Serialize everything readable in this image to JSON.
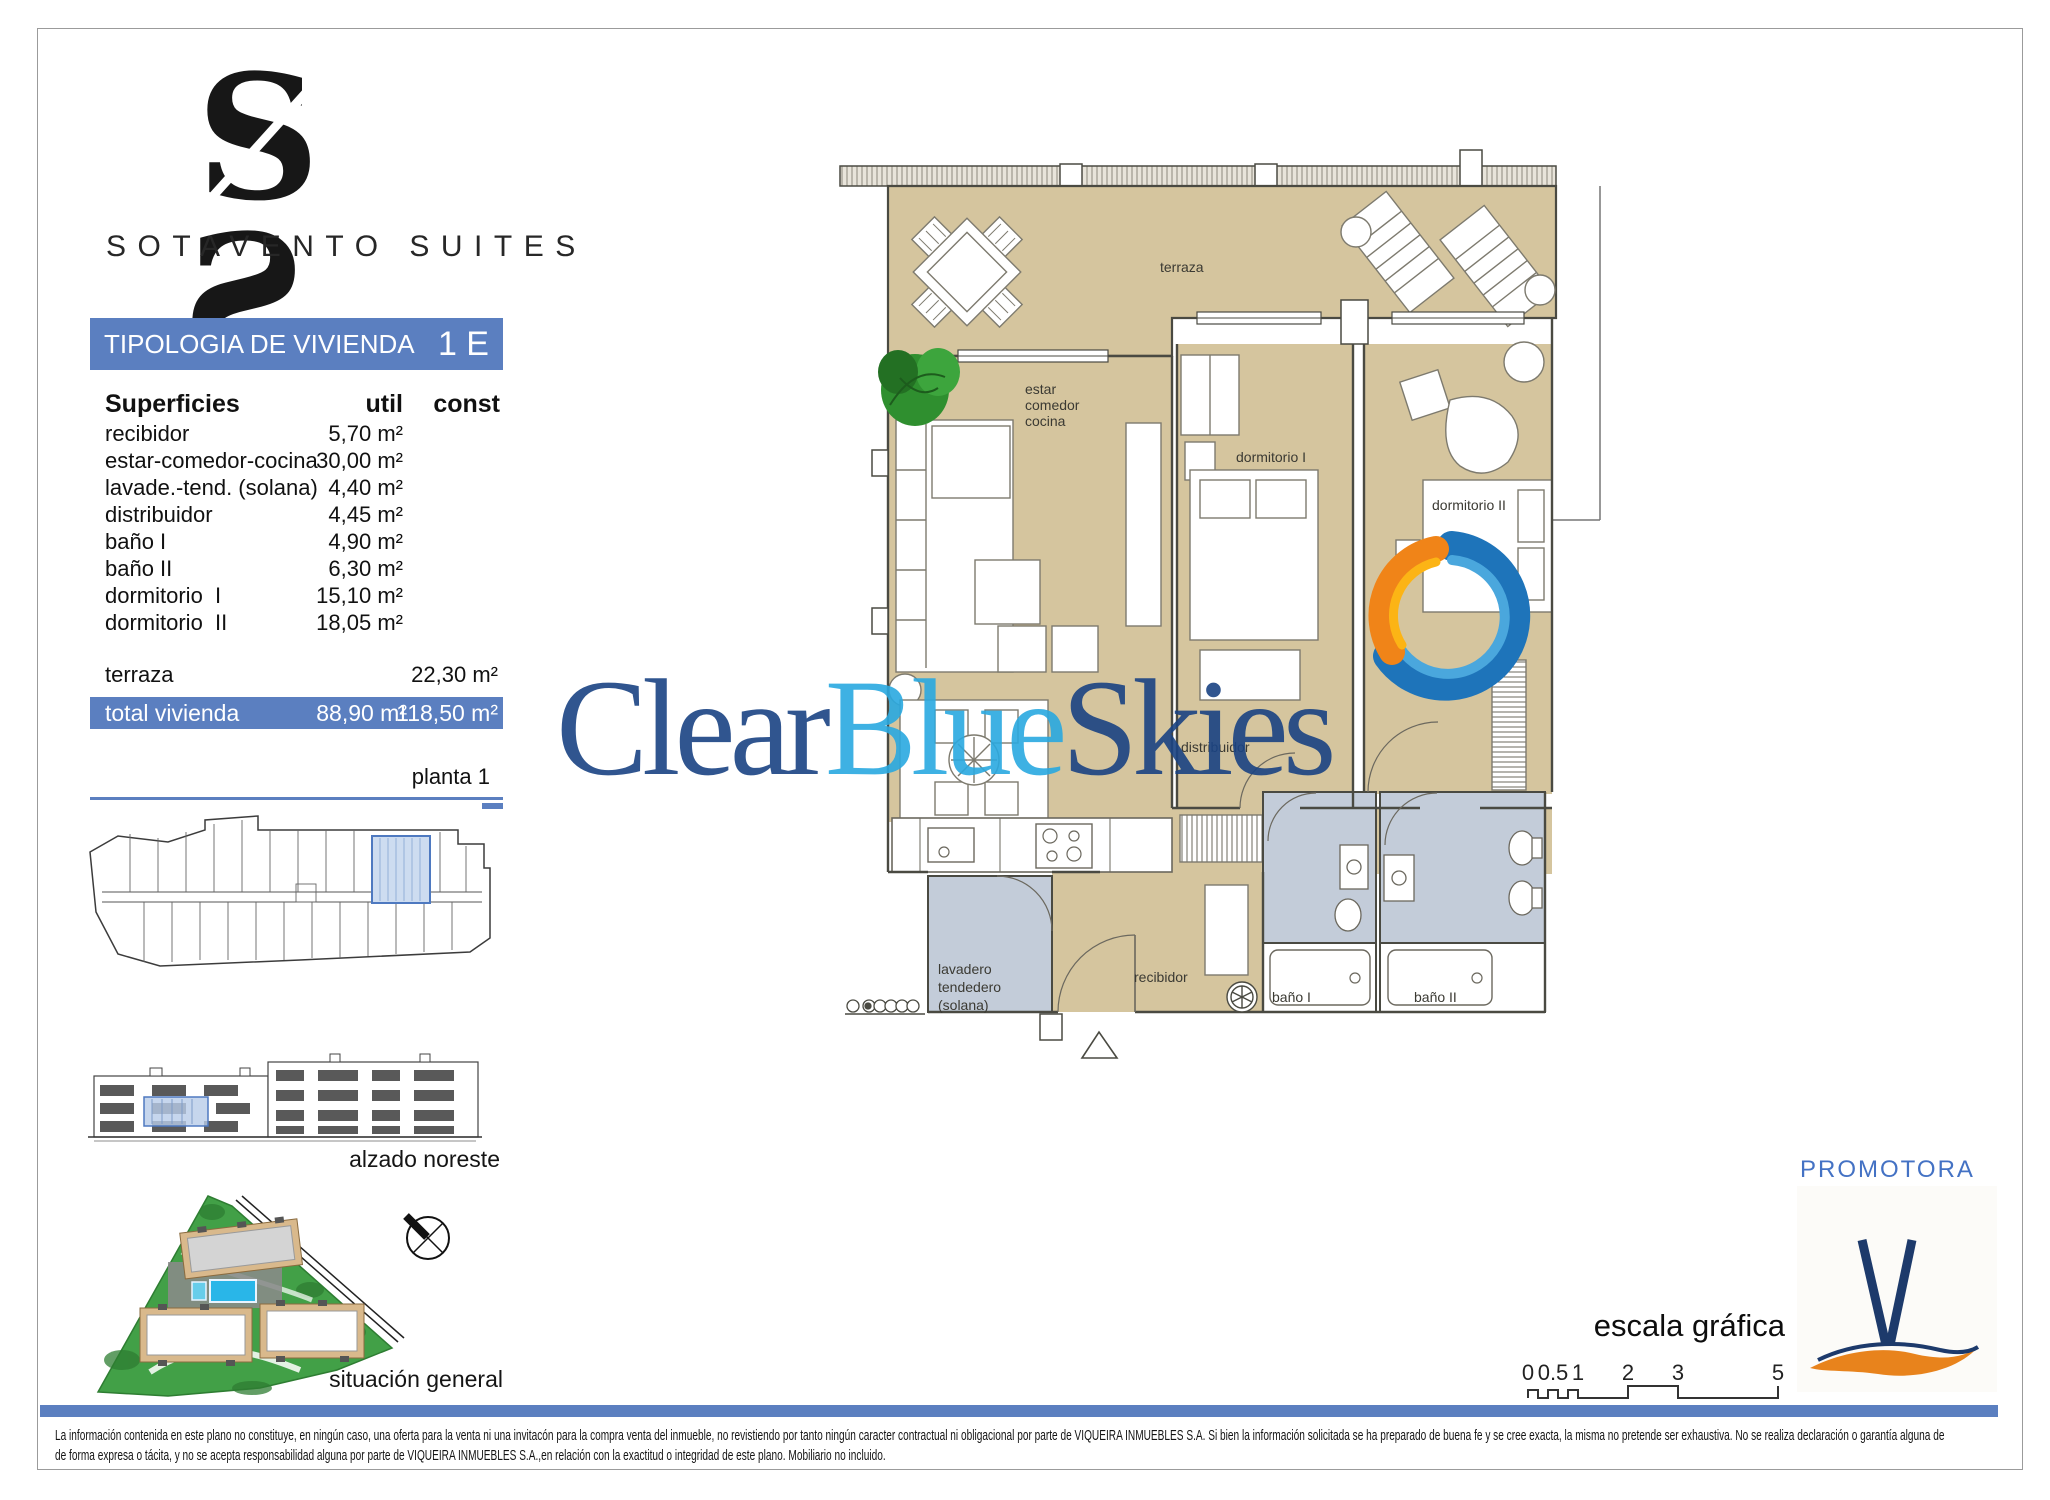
{
  "brand": {
    "monogram_left": "S",
    "monogram_right": "S",
    "name": "SOTAVENTO SUITES"
  },
  "header": {
    "title": "TIPOLOGIA DE VIVIENDA",
    "unit": "1 E"
  },
  "surfaces_table": {
    "title": "Superficies",
    "col_util": "util",
    "col_const": "const",
    "rows": [
      {
        "label": "recibidor",
        "util": "5,70 m²",
        "const": ""
      },
      {
        "label": "estar-comedor-cocina",
        "util": "30,00 m²",
        "const": ""
      },
      {
        "label": "lavade.-tend. (solana)",
        "util": "4,40 m²",
        "const": ""
      },
      {
        "label": "distribuidor",
        "util": "4,45 m²",
        "const": ""
      },
      {
        "label": "baño I",
        "util": "4,90 m²",
        "const": ""
      },
      {
        "label": "baño II",
        "util": "6,30 m²",
        "const": ""
      },
      {
        "label": "dormitorio  I",
        "util": "15,10 m²",
        "const": ""
      },
      {
        "label": "dormitorio  II",
        "util": "18,05 m²",
        "const": ""
      },
      {
        "label": "terraza",
        "util": "",
        "const": "22,30 m²"
      }
    ],
    "total": {
      "label": "total vivienda",
      "util": "88,90 m²",
      "const": "118,50 m²"
    },
    "floor_label": "planta 1"
  },
  "floor_plan_labels": {
    "terraza": "terraza",
    "estar_1": "estar",
    "estar_2": "comedor",
    "estar_3": "cocina",
    "dormitorio_1": "dormitorio I",
    "dormitorio_2": "dormitorio II",
    "distribuidor": "distribuidor",
    "lavadero_1": "lavadero",
    "lavadero_2": "tendedero",
    "lavadero_3": "(solana)",
    "recibidor": "recibidor",
    "bano_1": "baño I",
    "bano_2": "baño II"
  },
  "watermark": {
    "part1": "Clear",
    "part2": "Blue",
    "part3": "Skies"
  },
  "views": {
    "elevation_label": "alzado noreste",
    "siteplan_label": "situación general"
  },
  "promoter": {
    "label": "PROMOTORA"
  },
  "scale_bar": {
    "label": "escala gráfica",
    "ticks": [
      "0",
      "0.5",
      "1",
      "2",
      "3",
      "5"
    ]
  },
  "disclaimer": {
    "line1": "La información contenida en este plano no constituye, en ningún caso, una oferta para la venta ni una invitacón para la compra venta del inmueble, no revistiendo por tanto ningún caracter contractual ni obligacional por parte de VIQUEIRA INMUEBLES S.A. Si bien la información solicitada se ha preparado de buena fe y se cree exacta, la misma no pretende ser exhaustiva. No se realiza declaración o garantía alguna de",
    "line2": "de forma expresa o tácita, y no se acepta responsabilidad alguna por parte de VIQUEIRA INMUEBLES S.A.,en relación con la exactitud o integridad de este plano. Mobiliario no incluido."
  },
  "colors": {
    "accent_blue": "#5b7fc0",
    "promoter_blue": "#4472c4",
    "floor_tan": "#d5c59e",
    "bath_gray": "#c3ccd9",
    "watermark_navy": "#1a4383",
    "watermark_cyan": "#2aa9e0",
    "logo_orange": "#f08418",
    "logo_blue": "#1e74ba"
  }
}
